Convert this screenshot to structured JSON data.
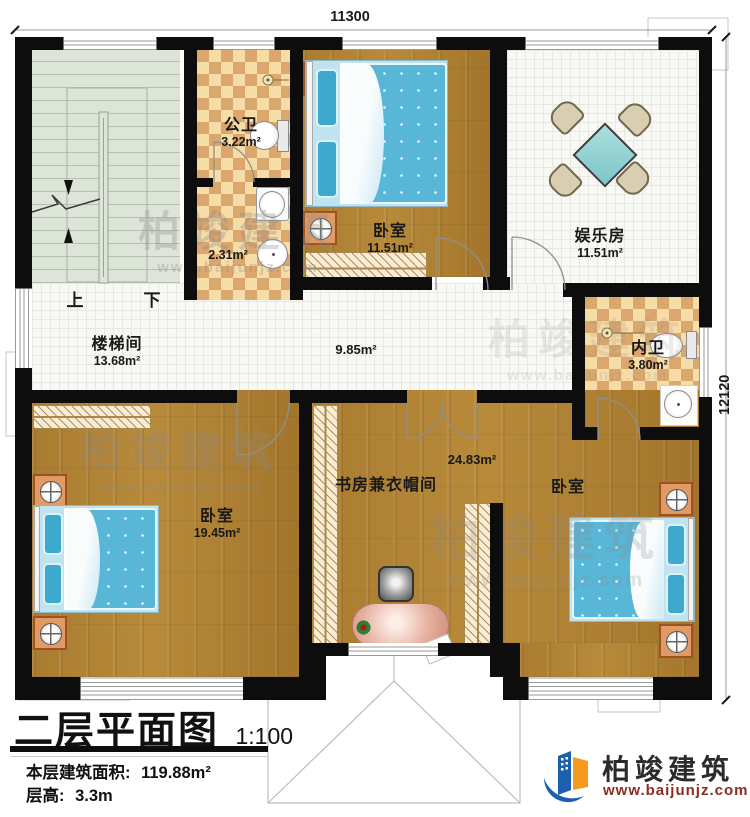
{
  "rooms": [
    {
      "name": "公卫",
      "area": "3.22m²"
    },
    {
      "name": "",
      "area": "2.31m²"
    },
    {
      "name": "卧室",
      "area": "11.51m²"
    },
    {
      "name": "娱乐房",
      "area": "11.51m²"
    },
    {
      "name": "楼梯间",
      "area": "13.68m²"
    },
    {
      "name": "",
      "area": "9.85m²"
    },
    {
      "name": "内卫",
      "area": "3.80m²"
    },
    {
      "name": "卧室",
      "area": "19.45m²"
    },
    {
      "name": "书房兼衣帽间",
      "area": "24.83m²"
    },
    {
      "name": "卧室",
      "area": ""
    }
  ],
  "stairs": {
    "up": "上",
    "down": "下"
  },
  "dimensions": {
    "top": "11300",
    "right": "12120"
  },
  "title": {
    "name": "二层平面图",
    "scale": "1:100",
    "area_label": "本层建筑面积:",
    "area_value": "119.88m²",
    "height_label": "层高:",
    "height_value": "3.3m"
  },
  "brand": {
    "name": "柏竣建筑",
    "url": "www.baijunjz.com"
  },
  "watermark": {
    "name": "柏竣建筑",
    "url": "www.baijunjz.com"
  },
  "colors": {
    "wall": "#0d0d0d",
    "wood": "#a87a30",
    "tile": "#f8f8f5",
    "checker_light": "#f6dca6",
    "checker_dark": "#dba76d",
    "stair": "#dde4d8",
    "bed_blue": "#58b6d6",
    "nightstand_orange": "#e09a66",
    "logo_blue": "#1b5fae",
    "logo_orange": "#f59a1e",
    "url_red": "#8d2a24"
  }
}
